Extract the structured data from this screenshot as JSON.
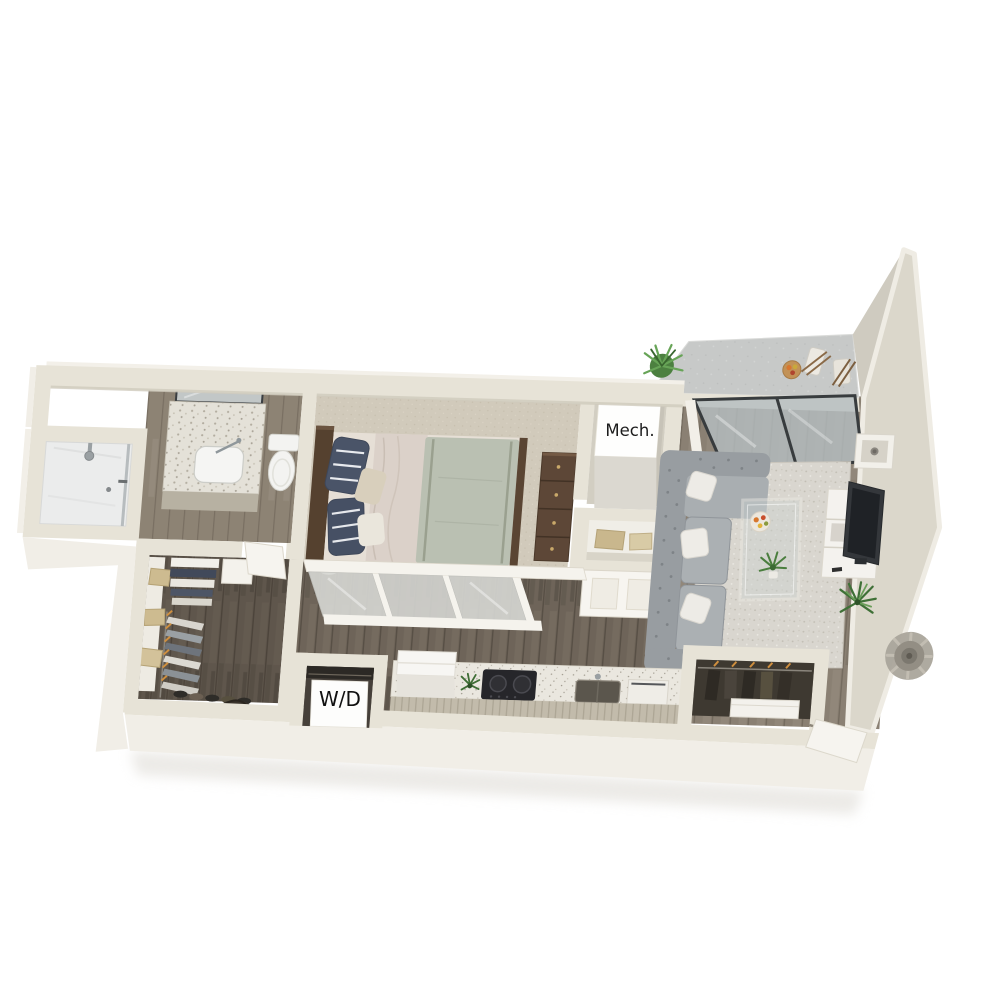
{
  "scene": {
    "title": "3D apartment floor plan render",
    "background": "#ffffff",
    "labels": {
      "mech_closet": "Mech.",
      "washer_dryer": "W/D"
    },
    "rooms": [
      {
        "name": "bathroom",
        "items": [
          "walk-in shower",
          "glass shower panel",
          "shower head",
          "terrazzo vanity with sink",
          "mirror with light bar",
          "toilet"
        ]
      },
      {
        "name": "walk-in-closet",
        "items": [
          "white shelving",
          "tan storage baskets",
          "folded linens",
          "clothes on hangers",
          "shoe row",
          "duffel bag"
        ]
      },
      {
        "name": "bedroom",
        "items": [
          "bed",
          "dark wood headboard",
          "navy striped pillows",
          "blush blanket",
          "sage duvet",
          "tall dresser",
          "frosted sliding partition",
          "carpet floor"
        ]
      },
      {
        "name": "mechanical-closet",
        "items": [
          "mechanical unit box",
          "linen niche with towels",
          "paneled closet door"
        ]
      },
      {
        "name": "laundry-closet",
        "items": [
          "stacked washer-dryer box",
          "shelf above"
        ]
      },
      {
        "name": "kitchen",
        "items": [
          "refrigerator",
          "black cooktop",
          "undermount sink",
          "dishwasher front",
          "speckled countertop",
          "ribbed base cabinets"
        ]
      },
      {
        "name": "living-room",
        "items": [
          "gray tufted sectional sofa",
          "white throw pillows",
          "speckled area rug",
          "glass coffee table",
          "fruit plate",
          "table plant",
          "white tv console",
          "flat-screen tv",
          "wall cube shelf",
          "floor plant",
          "sliding glass door"
        ]
      },
      {
        "name": "balcony",
        "items": [
          "concrete deck",
          "tall privacy wall",
          "two folding chairs",
          "fruit tray",
          "potted plant"
        ]
      },
      {
        "name": "entry",
        "items": [
          "coat closet with hangers",
          "low white cabinet",
          "open entry door",
          "round wall medallion"
        ]
      }
    ],
    "palette": {
      "wall_top": "#e7e3d7",
      "wall_bright": "#f1eee7",
      "wall_face": "#d9d4c8",
      "wall_shadow": "#bfb9ab",
      "wood_dark": "#6e6459",
      "wood_living": "#8a8073",
      "wood_bath": "#8d8374",
      "carpet": "#d1cabb",
      "concrete": "#c7c9c8",
      "rug": "#d9d6cf",
      "marble": "#ebecec",
      "sofa": "#a0a5a9",
      "duvet": "#bac0b2",
      "blanket": "#dbd1c9",
      "pillow_navy": "#4a5468",
      "furniture_wood": "#5c4636",
      "appliance_black": "#26262a",
      "plant_green": "#4a7e3e",
      "accent_orange": "#cf8f3f",
      "label_text": "#1c1c1c"
    }
  }
}
